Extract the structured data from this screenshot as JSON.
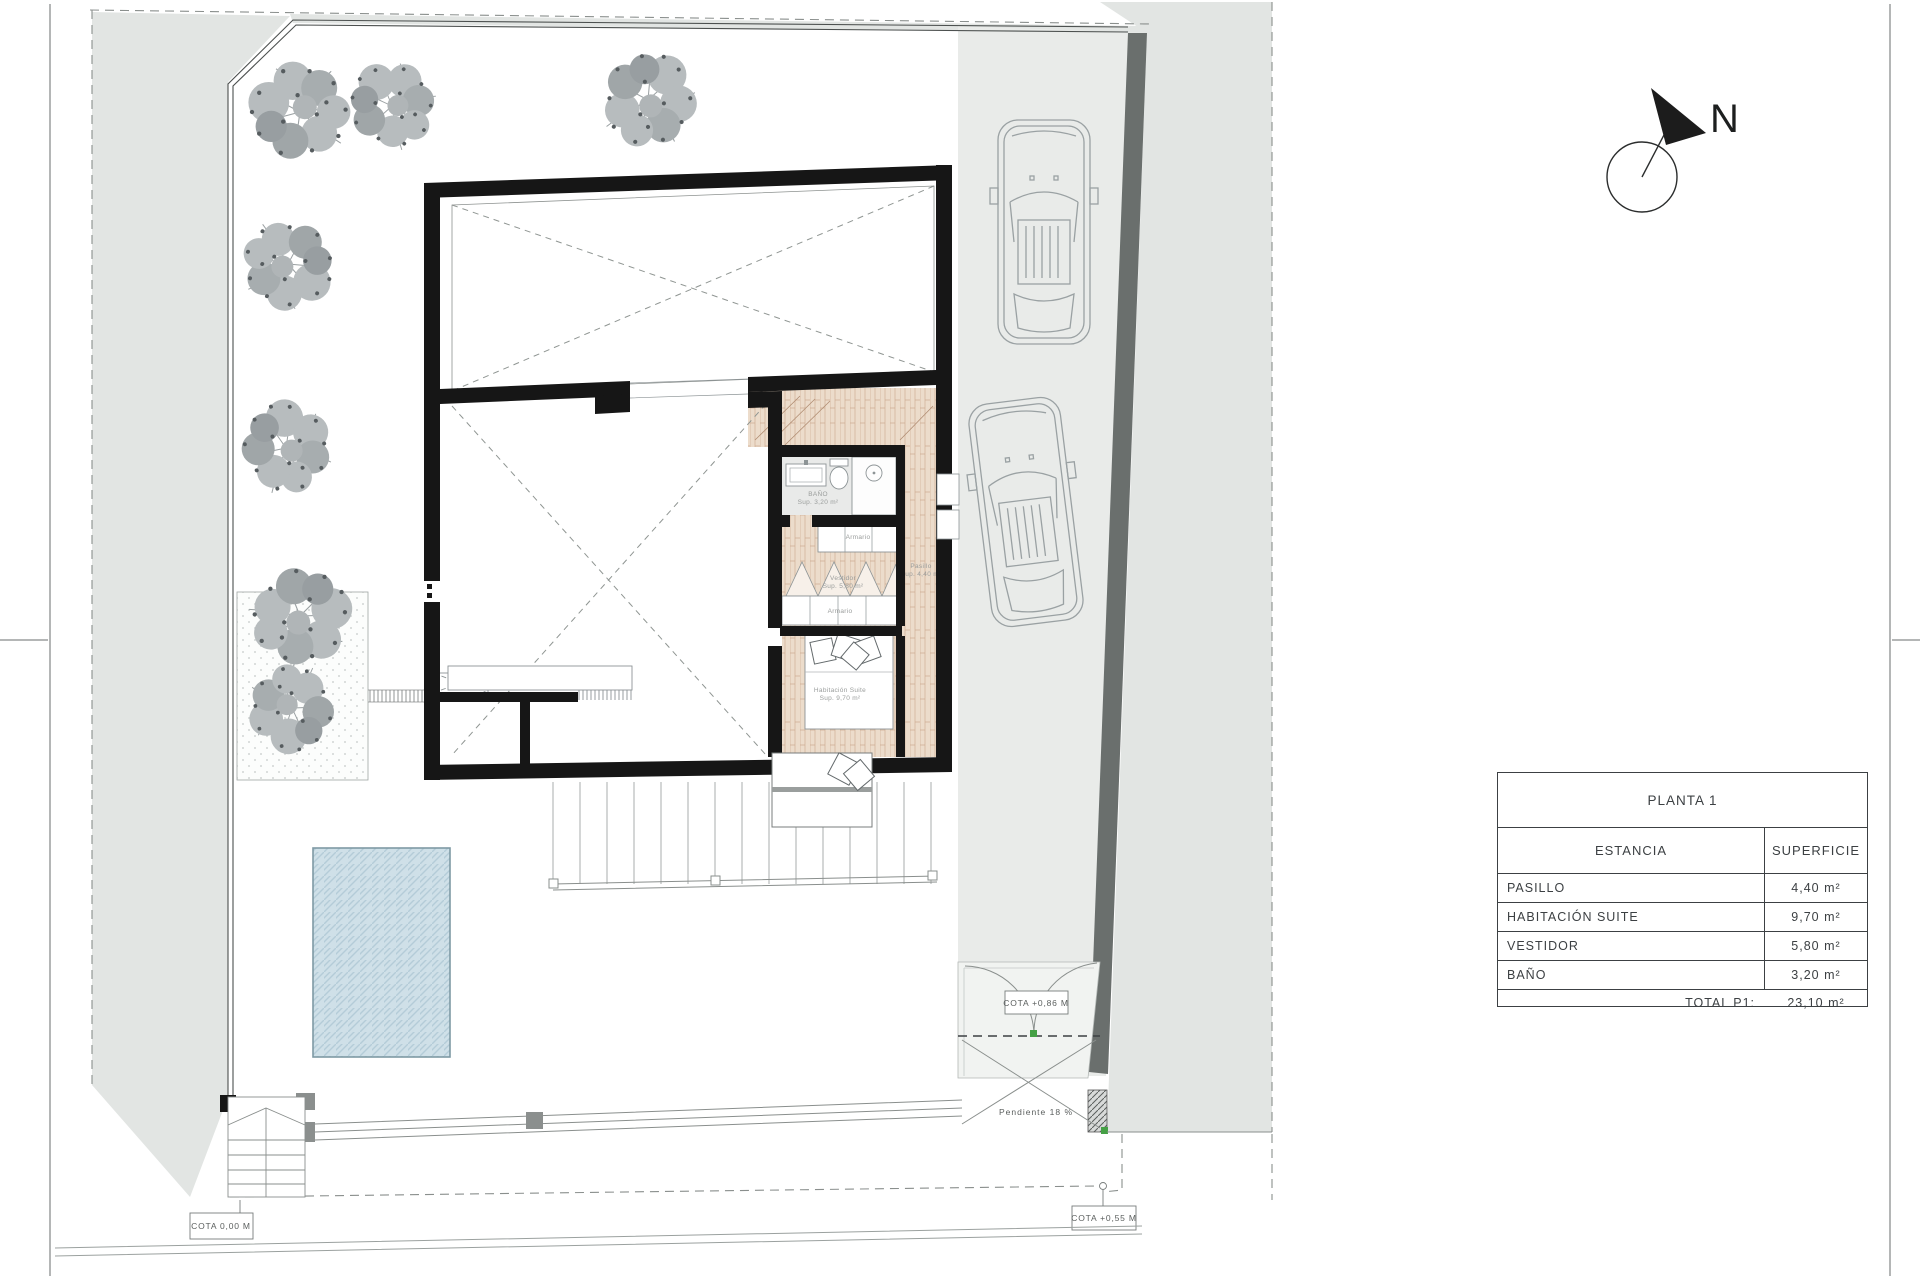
{
  "drawing": {
    "north_label": "N",
    "cotas": {
      "entry": "COTA 0,00 M",
      "street": "COTA +0,55 M",
      "gate": "COTA +0,86 M"
    },
    "slope_label": "Pendiente 18 %",
    "rooms": {
      "bano": {
        "name": "BAÑO",
        "sup": "Sup. 3,20 m²"
      },
      "vestidor": {
        "name": "Vestidor",
        "sup": "Sup. 5,80 m²"
      },
      "pasillo": {
        "name": "Pasillo",
        "sup": "Sup. 4,40 m²"
      },
      "suite": {
        "name": "Habitación Suite",
        "sup": "Sup. 9,70 m²"
      },
      "armario": "Armario"
    }
  },
  "legend": {
    "title": "PLANTA 1",
    "col_room": "ESTANCIA",
    "col_area": "SUPERFICIE",
    "rows": [
      {
        "name": "PASILLO",
        "area": "4,40 m²"
      },
      {
        "name": "HABITACIÓN SUITE",
        "area": "9,70 m²"
      },
      {
        "name": "VESTIDOR",
        "area": "5,80 m²"
      },
      {
        "name": "BAÑO",
        "area": "3,20 m²"
      }
    ],
    "total_label": "TOTAL P1:",
    "total_area": "23,10 m²"
  },
  "colors": {
    "neighbor_gray": "#e2e5e3",
    "driveway_gray": "#e9ebe9",
    "apron_gray": "#f1f3f1",
    "boundary_wall_dark": "#6a6f6d",
    "wall_black": "#161616",
    "wood_floor": "#ecdccb",
    "pool_fill": "#cfe0e8",
    "pool_border": "#7e99a4",
    "marker_green": "#45a045"
  }
}
